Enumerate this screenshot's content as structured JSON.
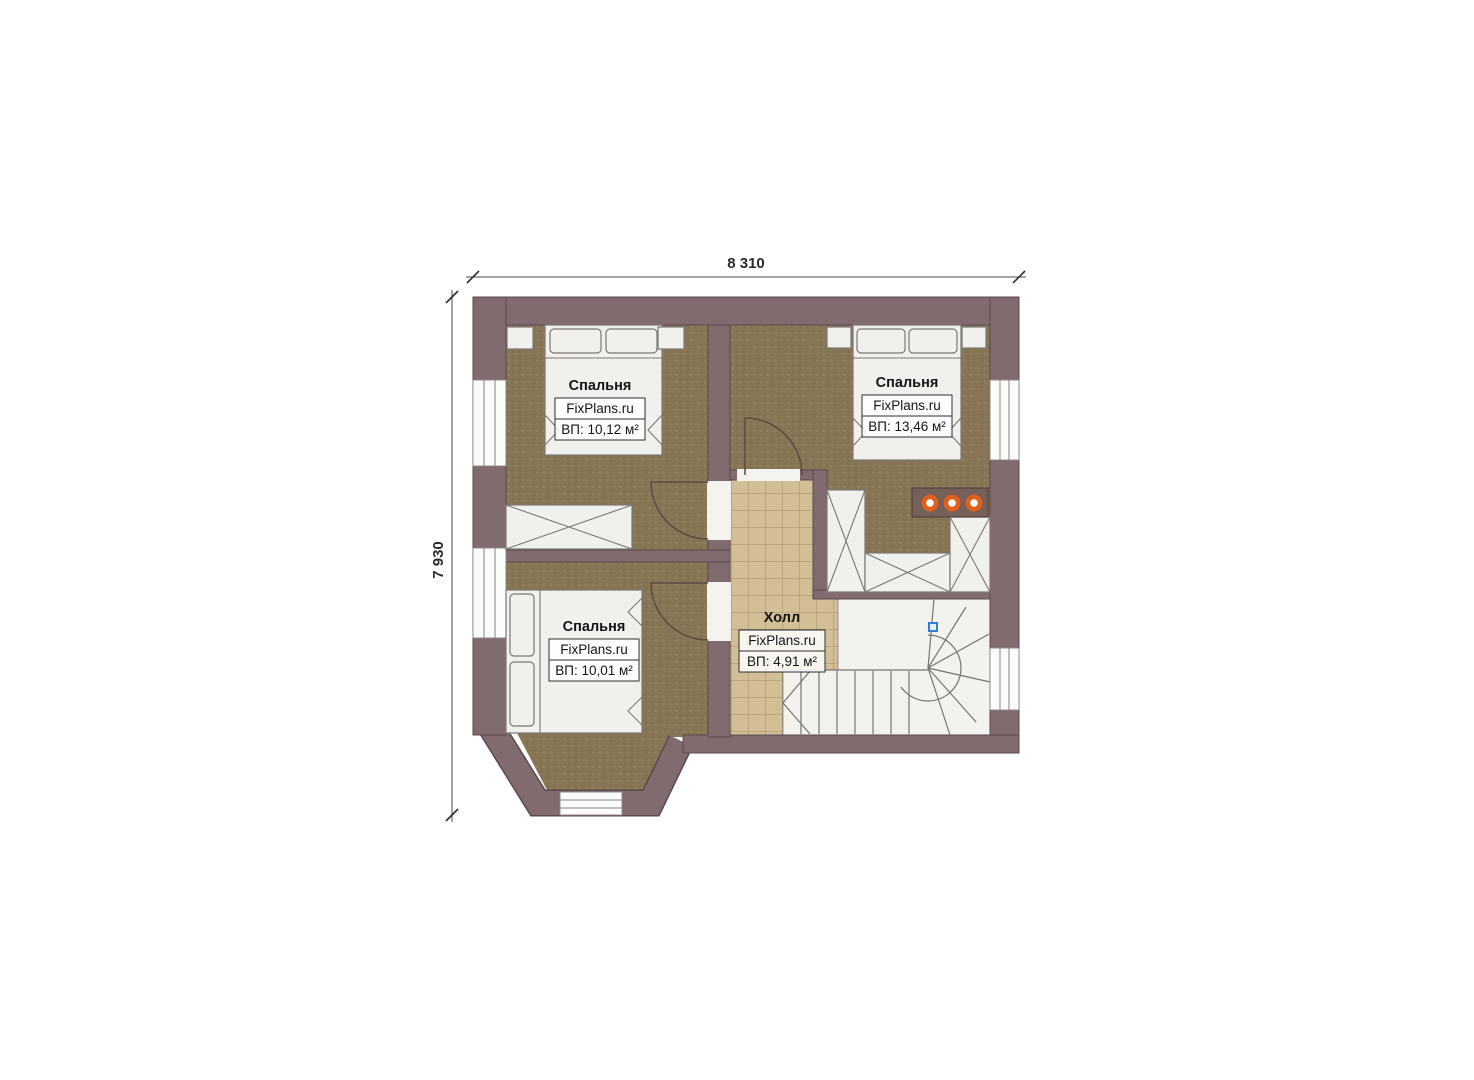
{
  "plan": {
    "dimension_width": {
      "label": "8 310"
    },
    "dimension_height": {
      "label": "7 930"
    },
    "rooms": [
      {
        "name": "Спальня",
        "watermark": "FixPlans.ru",
        "area": "ВП: 10,12 м²"
      },
      {
        "name": "Спальня",
        "watermark": "FixPlans.ru",
        "area": "ВП: 13,46 м²"
      },
      {
        "name": "Спальня",
        "watermark": "FixPlans.ru",
        "area": "ВП: 10,01 м²"
      },
      {
        "name": "Холл",
        "watermark": "FixPlans.ru",
        "area": "ВП: 4,91 м²"
      }
    ],
    "colors": {
      "wall": "#826b6f",
      "wall_outline": "#5a4a4d",
      "carpet": "#877655",
      "tile": "#d3bf96",
      "furniture": "#f1f0ec",
      "knob_accent": "#e2601f",
      "stair_marker": "#2f7fd6"
    }
  }
}
